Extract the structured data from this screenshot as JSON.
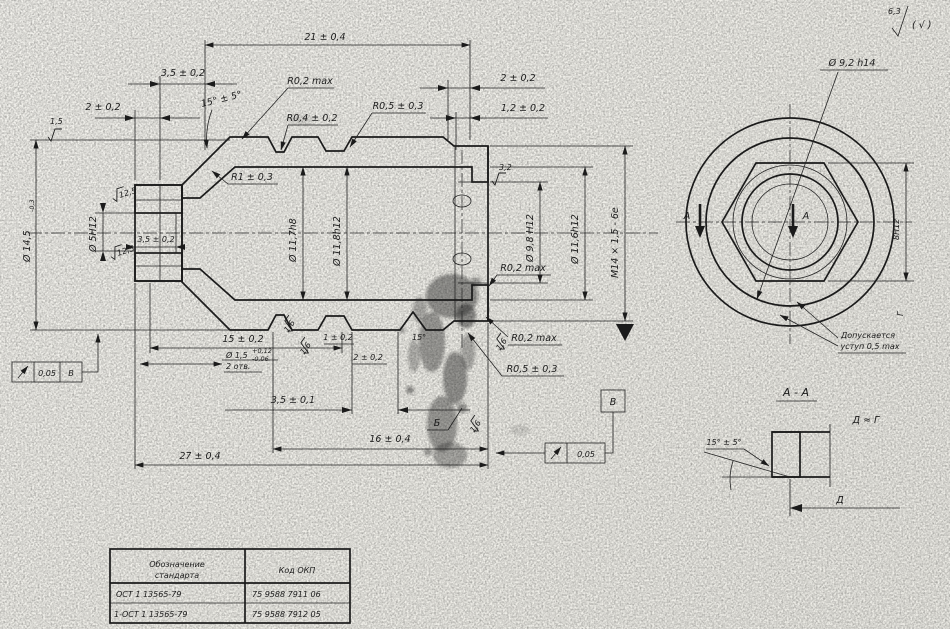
{
  "general_roughness": {
    "value": "6,3",
    "alt": "( √ )"
  },
  "main_view": {
    "dim_21": "21 ± 0,4",
    "dim_35_top": "3,5 ± 0,2",
    "dim_2_left": "2 ± 0,2",
    "dim_2_right": "2 ± 0,2",
    "dim_12": "1,2 ± 0,2",
    "angle_cone": "15° ± 5°",
    "r02_top": "R0,2 max",
    "r04": "R0,4 ± 0,2",
    "r05_top": "R0,5 ± 0,3",
    "r1": "R1 ± 0,3",
    "dia_145": {
      "base": "Ø 14,5",
      "tol": "-0,3"
    },
    "dia_5": "Ø 5H12",
    "rough_125": "12,5",
    "dim_35_bore": "3,5 ± 0,2",
    "dia_117": "Ø 11,7h8",
    "dia_118": "Ø 11,8h12",
    "dia_98": "Ø 9,8 H12",
    "dia_116": "Ø 11,6h12",
    "thread": "M14 × 1,5 - 6e",
    "rough_32": "3,2",
    "rough_15": "1,5",
    "rough_16": "1,6",
    "r02_right": "R0,2 max",
    "r02_bottom": "R0,2 max",
    "r05_bottom": "R0,5 ± 0,3",
    "dim_15": "15 ± 0,2",
    "hole": {
      "base": "Ø 1,5",
      "up": "+0,12",
      "dn": "-0,06",
      "note": "2 отв."
    },
    "dim_1": "1 ± 0,2",
    "dim_2_groove": "2 ± 0,2",
    "angle_groove": "15°",
    "dim_35_01": "3,5 ± 0,1",
    "dim_16": "16 ± 0,4",
    "dim_27": "27 ± 0,4",
    "surf_b": "Б",
    "datum_v": "В",
    "runout_left": "0,05",
    "runout_right": "0,05"
  },
  "end_view": {
    "dia_92": "Ø 9,2 h14",
    "dim_8": "8H12",
    "label_g": "Г",
    "note1": "Допускается",
    "note2": "уступ 0,5 max",
    "section": "А"
  },
  "section_aa": {
    "title": "А - А",
    "angle": "15° ± 5°",
    "equal": "Д ≈ Г",
    "dim_d": "Д"
  },
  "table": {
    "header1a": "Обозначение",
    "header1b": "стандарта",
    "header2": "Код ОКП",
    "rows": [
      {
        "std": "ОСТ 1 13565-79",
        "okp": "75 9588 7911 06"
      },
      {
        "std": "1-ОСТ 1 13565-79",
        "okp": "75 9588 7912 05"
      }
    ]
  }
}
